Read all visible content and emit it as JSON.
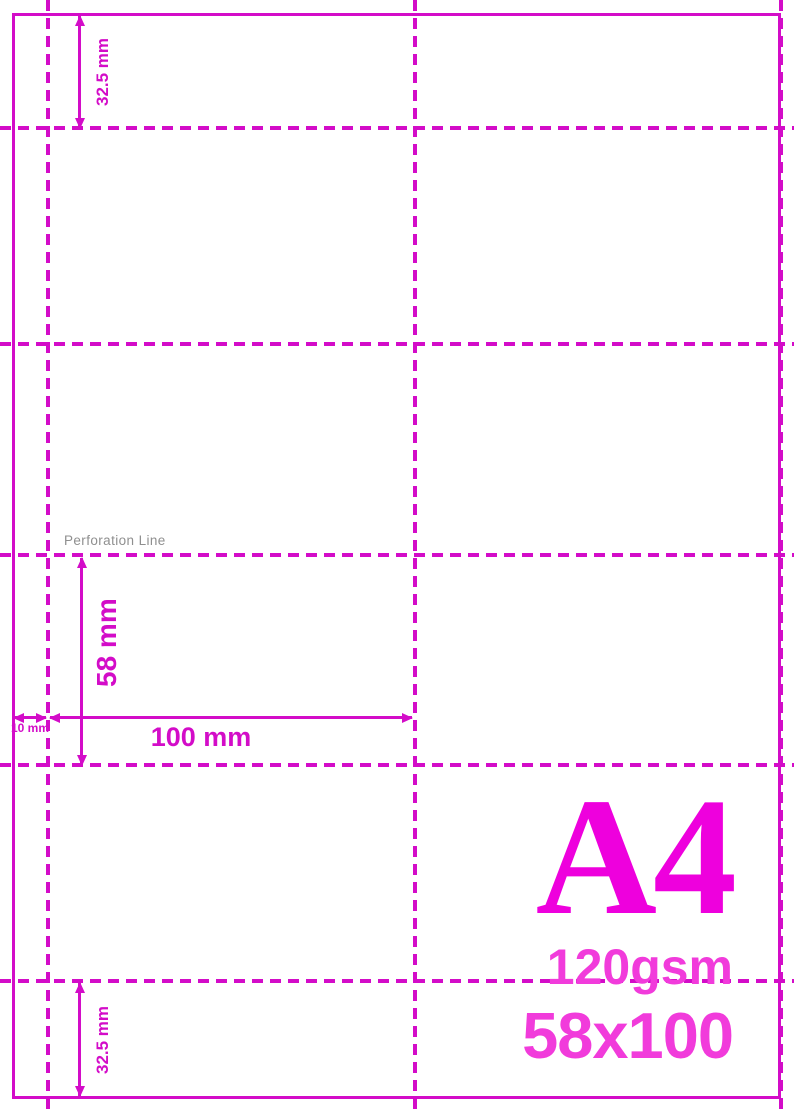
{
  "template": {
    "title": "A4",
    "paper_weight": "120gsm",
    "label_size": "58x100",
    "perforation_line_label": "Perforation Line",
    "dimensions": {
      "top_margin": "32.5 mm",
      "bottom_margin": "32.5 mm",
      "cell_height": "58 mm",
      "cell_width": "100 mm",
      "left_margin": "10 mm"
    },
    "grid": {
      "columns": 2,
      "rows": 4,
      "column_width_mm": 100,
      "row_height_mm": 58
    },
    "colors": {
      "line": "#d30cc8",
      "format_text": "#ee00dd",
      "spec_text": "#f13bdb",
      "note_text": "#8f8f8f"
    }
  }
}
